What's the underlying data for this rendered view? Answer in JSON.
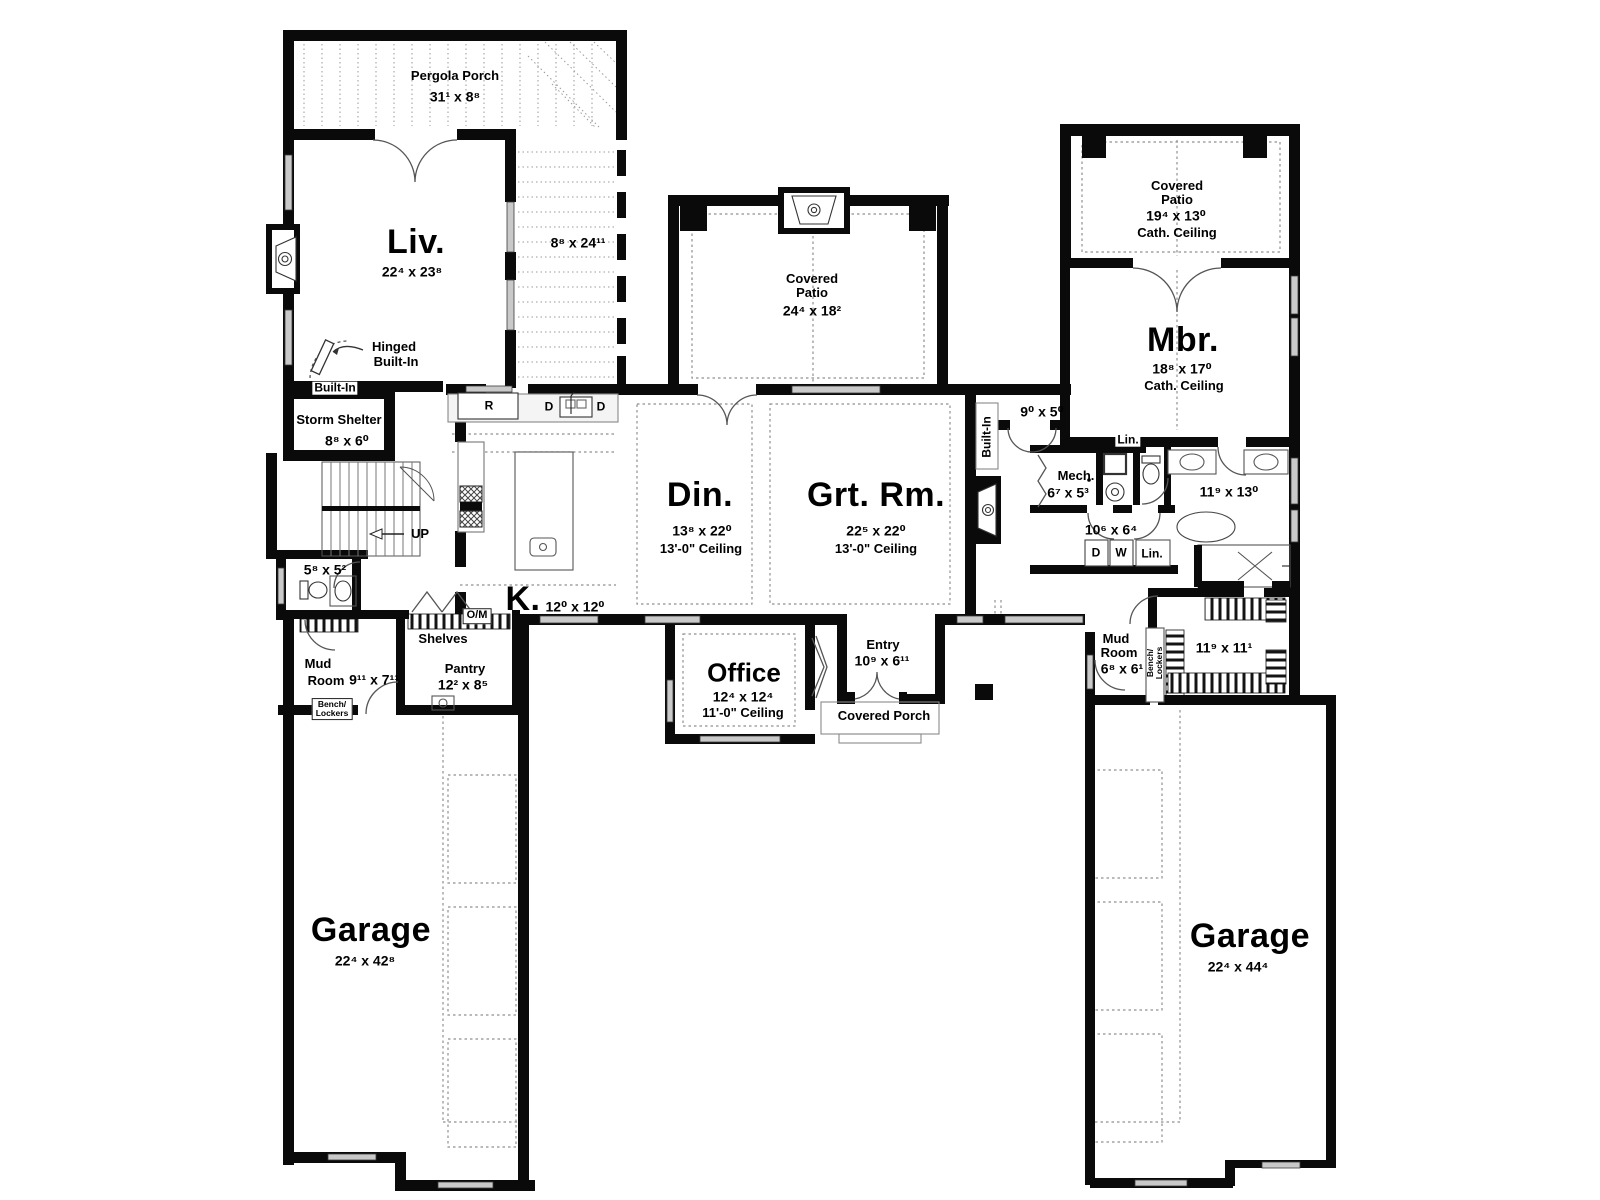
{
  "page": {
    "type": "architectural floor plan",
    "view": "main level"
  },
  "colors": {
    "wall": "#0a0a0a",
    "window": "#c9c9c9",
    "dash": "#8f8f8f",
    "text": "#000000",
    "background": "#ffffff"
  },
  "labels": {
    "pergola_porch_name": "Pergola Porch",
    "pergola_porch_dims": "31¹ x 8⁸",
    "living_name": "Liv.",
    "living_dims": "22⁴ x 23⁸",
    "deck_dims": "8⁸ x 24¹¹",
    "hinged_builtin_line1": "Hinged",
    "hinged_builtin_line2": "Built-In",
    "builtin_living": "Built-In",
    "storm_shelter_name": "Storm Shelter",
    "storm_shelter_dims": "8⁸ x 6⁰",
    "stairs_up": "UP",
    "powder_bath_dims": "5⁸ x 5²",
    "mud_room_left_line1": "Mud",
    "mud_room_left_line2": "Room",
    "mud_room_left_dims": "9¹¹ x 7¹¹",
    "bench_lockers_left_line1": "Bench/",
    "bench_lockers_left_line2": "Lockers",
    "shelves": "Shelves",
    "oven_micro": "O/M",
    "pantry_name": "Pantry",
    "pantry_dims": "12² x 8⁵",
    "kitchen_name": "K.",
    "kitchen_dims": "12⁰ x 12⁰",
    "range": "R",
    "dishwasher_left": "D",
    "dishwasher_right": "D",
    "dining_name": "Din.",
    "dining_dims": "13⁸ x 22⁰",
    "dining_ceiling": "13'-0\" Ceiling",
    "great_room_name": "Grt. Rm.",
    "great_room_dims": "22⁵ x 22⁰",
    "great_room_ceiling": "13'-0\" Ceiling",
    "patio_main_line1": "Covered",
    "patio_main_line2": "Patio",
    "patio_main_dims": "24⁴ x 18²",
    "patio_right_line1": "Covered",
    "patio_right_line2": "Patio",
    "patio_right_dims": "19⁴ x 13⁰",
    "patio_right_ceiling": "Cath. Ceiling",
    "master_name": "Mbr.",
    "master_dims": "18⁸ x 17⁰",
    "master_ceiling": "Cath. Ceiling",
    "builtin_great_room": "Built-In",
    "hall_dims": "9⁰ x 5⁰",
    "mech_name": "Mech.",
    "mech_dims": "6⁷ x 5³",
    "linen1": "Lin.",
    "master_bath_dims": "11⁹ x 13⁰",
    "laundry_dims": "10⁶ x 6⁴",
    "dryer": "D",
    "washer": "W",
    "linen2": "Lin.",
    "closet_dims": "11⁹ x 11¹",
    "mud_room_right_line1": "Mud",
    "mud_room_right_line2": "Room",
    "mud_room_right_dims": "6⁸ x 6¹",
    "bench_lockers_right_line1": "Bench/",
    "bench_lockers_right_line2": "Lockers",
    "office_name": "Office",
    "office_dims": "12⁴ x 12⁴",
    "office_ceiling": "11'-0\" Ceiling",
    "entry_name": "Entry",
    "entry_dims": "10⁹ x 6¹¹",
    "covered_porch": "Covered Porch",
    "garage_left_name": "Garage",
    "garage_left_dims": "22⁴ x 42⁸",
    "garage_right_name": "Garage",
    "garage_right_dims": "22⁴ x 44⁴"
  }
}
